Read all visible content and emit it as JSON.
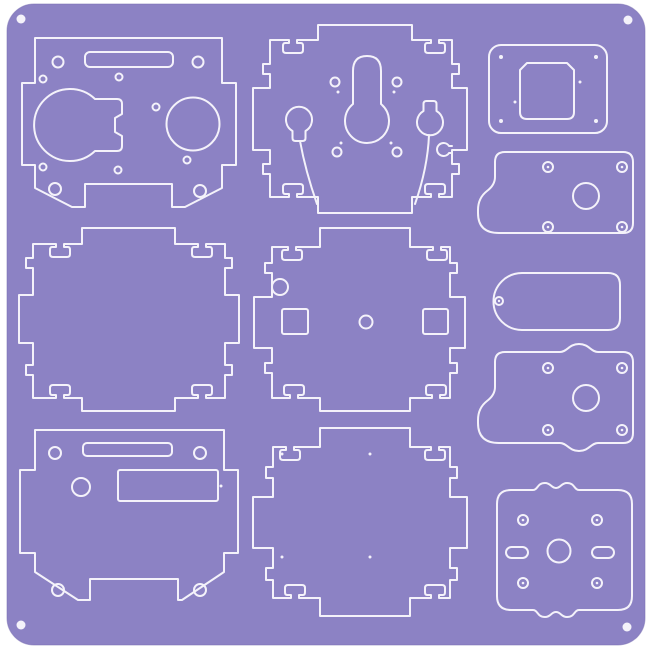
{
  "colors": {
    "page_background": "#ffffff",
    "sheet_fill": "#8c82c4",
    "sheet_edge": "#7a70b2",
    "cut_line": "#f4f2fa",
    "stroke_width": 2
  },
  "sheet": {
    "x": 7,
    "y": 4,
    "width": 638,
    "height": 641,
    "corner_radius": 27,
    "registration_dots": [
      {
        "cx": 21,
        "cy": 19,
        "r": 4.5
      },
      {
        "cx": 628,
        "cy": 20,
        "r": 4.5
      },
      {
        "cx": 21,
        "cy": 625,
        "r": 4.5
      },
      {
        "cx": 627,
        "cy": 627,
        "r": 4.5
      }
    ]
  },
  "parts": [
    {
      "name": "front-panel",
      "elements": [
        {
          "shape": "path",
          "name": "front-panel-outline",
          "d": "M 35,38 H 222 V 83 H 236 V 165 H 222 V 188 L 185,207 H 172 V 184 H 85 V 207 H 72 L 35,188 V 165 H 22 V 83 H 35 Z"
        },
        {
          "shape": "rect",
          "name": "front-panel-slot",
          "x": 85,
          "y": 52,
          "w": 88,
          "h": 15,
          "rx": 5
        },
        {
          "shape": "path",
          "name": "speaker-keyed-hole",
          "d": "M 95,99 A 36,36 0 1 0 95,151 H 117 Q 122,151 122,146 V 136 L 115,132 V 118 L 122,114 V 104 Q 122,99 117,99 Z"
        },
        {
          "shape": "circle",
          "name": "round-hole",
          "cx": 193,
          "cy": 124,
          "r": 26.5
        },
        {
          "shape": "circle",
          "name": "screw-hole",
          "cx": 58,
          "cy": 62,
          "r": 5.5
        },
        {
          "shape": "circle",
          "name": "screw-hole",
          "cx": 198,
          "cy": 62,
          "r": 5.5
        },
        {
          "shape": "circle",
          "name": "screw-hole",
          "cx": 55,
          "cy": 189,
          "r": 6
        },
        {
          "shape": "circle",
          "name": "screw-hole",
          "cx": 200,
          "cy": 191,
          "r": 6
        },
        {
          "shape": "circle",
          "name": "pin-hole",
          "cx": 43,
          "cy": 79,
          "r": 3.5
        },
        {
          "shape": "circle",
          "name": "pin-hole",
          "cx": 119,
          "cy": 77,
          "r": 3.5
        },
        {
          "shape": "circle",
          "name": "pin-hole",
          "cx": 156,
          "cy": 107,
          "r": 3.5
        },
        {
          "shape": "circle",
          "name": "pin-hole",
          "cx": 43,
          "cy": 167,
          "r": 3.5
        },
        {
          "shape": "circle",
          "name": "pin-hole",
          "cx": 118,
          "cy": 170,
          "r": 3.5
        },
        {
          "shape": "circle",
          "name": "pin-hole",
          "cx": 187,
          "cy": 160,
          "r": 3.5
        }
      ]
    },
    {
      "name": "side-panel-left",
      "elements": [
        {
          "shape": "path",
          "name": "side-panel-left-outline",
          "d": "M 33,244 H 56 V 247 H 52 Q 50,247 50,250 V 254 Q 50,257 53,257 H 67 Q 70,257 70,254 V 250 Q 70,247 68,247 H 64 V 244 H 82 V 228 H 175 V 244 H 198 V 247 H 194 Q 192,247 192,250 V 254 Q 192,257 195,257 H 209 Q 212,257 212,254 V 250 Q 212,247 210,247 H 206 V 244 H 225 V 258 H 232 V 268 H 225 V 295 H 239 V 343 H 225 V 365 H 232 V 375 H 225 V 398 H 206 V 395 H 210 Q 212,395 212,392 V 388 Q 212,385 209,385 H 195 Q 192,385 192,388 V 392 Q 192,395 194,395 H 198 V 398 H 175 V 411 H 82 V 398 H 64 V 395 H 68 Q 70,395 70,392 V 388 Q 70,385 67,385 H 53 Q 50,385 50,388 V 392 Q 50,395 52,395 H 56 V 398 H 33 V 375 H 26 V 365 H 33 V 343 H 19 V 295 H 33 V 268 H 26 V 258 H 33 Z"
        }
      ]
    },
    {
      "name": "bottom-panel",
      "elements": [
        {
          "shape": "path",
          "name": "bottom-panel-outline",
          "d": "M 35,430 H 224 V 470 H 238 V 553 H 224 V 572 L 182,600 H 178 V 579 H 90 V 600 H 78 L 35,572 V 553 H 20 V 470 H 35 Z"
        },
        {
          "shape": "rect",
          "name": "top-slot",
          "x": 83,
          "y": 443,
          "w": 89,
          "h": 13,
          "rx": 4
        },
        {
          "shape": "rect",
          "name": "display-window",
          "x": 118,
          "y": 470,
          "w": 100,
          "h": 31,
          "rx": 2
        },
        {
          "shape": "circle",
          "name": "round-hole",
          "cx": 81,
          "cy": 487,
          "r": 9
        },
        {
          "shape": "circle",
          "name": "screw-hole",
          "cx": 55,
          "cy": 453,
          "r": 6
        },
        {
          "shape": "circle",
          "name": "screw-hole",
          "cx": 200,
          "cy": 453,
          "r": 6
        },
        {
          "shape": "circle",
          "name": "screw-hole",
          "cx": 58,
          "cy": 590,
          "r": 6
        },
        {
          "shape": "circle",
          "name": "screw-hole",
          "cx": 200,
          "cy": 590,
          "r": 6
        },
        {
          "shape": "dot",
          "name": "pin-mark",
          "cx": 221,
          "cy": 486,
          "r": 1.5
        }
      ]
    },
    {
      "name": "back-panel",
      "elements": [
        {
          "shape": "path",
          "name": "back-panel-outline",
          "d": "M 270,40 H 289 V 43 H 285 Q 283,43 283,46 V 50 Q 283,53 286,53 H 300 Q 303,53 303,50 V 46 Q 303,43 301,43 H 297 V 40 H 318 V 25 H 412 V 40 H 431 V 43 H 427 Q 425,43 425,46 V 50 Q 425,53 428,53 H 442 Q 445,53 445,50 V 46 Q 445,43 443,43 H 439 V 40 H 452 V 64 H 459 V 74 H 452 V 88 H 467 V 150 H 452 V 164 H 459 V 174 H 452 V 197 H 439 V 194 H 443 Q 445,194 445,191 V 187 Q 445,184 442,184 H 428 Q 425,184 425,187 V 191 Q 425,194 427,194 H 431 V 197 H 412 V 213 H 318 V 197 H 297 V 194 H 301 Q 303,194 303,191 V 187 Q 303,184 300,184 H 286 Q 283,184 283,187 V 191 Q 283,194 285,194 H 289 V 197 H 270 V 174 H 263 V 164 H 270 V 150 H 253 V 88 H 270 V 74 H 263 V 64 H 270 Z"
        },
        {
          "shape": "path",
          "name": "keyhole-cutout",
          "d": "M 353,71 Q 353,56 367,56 Q 381,56 381,71 V 104 A 22,22 0 1 1 353,104 Z"
        },
        {
          "shape": "path",
          "name": "balloon-cutout-left",
          "d": "M 292.5,131 A 13,13 0 1 1 305.5,131 V 138 Q 305.5,141 302.5,141 H 295.5 Q 292.5,141 292.5,138 Z"
        },
        {
          "shape": "path",
          "name": "curved-cut-left",
          "d": "M 300,141 C 304,163 310,184 317,204"
        },
        {
          "shape": "path",
          "name": "balloon-cutout-right",
          "d": "M 423.5,111 V 104 Q 423.5,101 426.5,101 H 433.5 Q 436.5,101 436.5,104 V 111 A 13,13 0 1 1 423.5,111 Z"
        },
        {
          "shape": "path",
          "name": "curved-cut-right",
          "d": "M 429,135 C 428,160 422,184 415,204"
        },
        {
          "shape": "path",
          "name": "edge-keyhole-slot",
          "d": "M 452,146 H 449 A 6.5,6.5 0 1 0 449,153 H 452"
        },
        {
          "shape": "circle",
          "name": "screw-hole",
          "cx": 335,
          "cy": 82,
          "r": 4.5
        },
        {
          "shape": "circle",
          "name": "screw-hole",
          "cx": 397,
          "cy": 82,
          "r": 4.5
        },
        {
          "shape": "circle",
          "name": "screw-hole",
          "cx": 337,
          "cy": 152,
          "r": 4.5
        },
        {
          "shape": "circle",
          "name": "screw-hole",
          "cx": 397,
          "cy": 152,
          "r": 4.5
        },
        {
          "shape": "dot",
          "name": "pin-mark",
          "cx": 338,
          "cy": 92,
          "r": 1.5
        },
        {
          "shape": "dot",
          "name": "pin-mark",
          "cx": 394,
          "cy": 92,
          "r": 1.5
        },
        {
          "shape": "dot",
          "name": "pin-mark",
          "cx": 341,
          "cy": 143,
          "r": 1.5
        },
        {
          "shape": "dot",
          "name": "pin-mark",
          "cx": 391,
          "cy": 143,
          "r": 1.5
        }
      ]
    },
    {
      "name": "side-panel-right",
      "elements": [
        {
          "shape": "path",
          "name": "side-panel-right-outline",
          "d": "M 272,247 H 288 V 250 H 284 Q 282,250 282,253 V 257 Q 282,260 285,260 H 299 Q 302,260 302,257 V 253 Q 302,250 300,250 H 296 V 247 H 320 V 228 H 410 V 247 H 433 V 250 H 429 Q 427,250 427,253 V 257 Q 427,260 430,260 H 444 Q 447,260 447,257 V 253 Q 447,250 445,250 H 441 V 247 H 450 V 263 H 457 V 273 H 450 V 297 H 465 V 348 H 450 V 363 H 457 V 373 H 450 V 398 H 440 V 395 H 444 Q 446,395 446,392 V 388 Q 446,385 443,385 H 429 Q 426,385 426,388 V 392 Q 426,395 428,395 H 432 V 398 H 410 V 411 H 320 V 398 H 298 V 395 H 302 Q 304,395 304,392 V 388 Q 304,385 301,385 H 287 Q 284,385 284,388 V 392 Q 284,395 286,395 H 290 V 398 H 272 V 373 H 265 V 363 H 272 V 348 H 254 V 297 H 272 V 273 H 265 V 263 H 272 Z"
        },
        {
          "shape": "circle",
          "name": "edge-notch-hole",
          "cx": 280,
          "cy": 287,
          "r": 8
        },
        {
          "shape": "rect",
          "name": "square-hole",
          "x": 282,
          "y": 309,
          "w": 26,
          "h": 25,
          "rx": 2
        },
        {
          "shape": "rect",
          "name": "square-hole",
          "x": 423,
          "y": 309,
          "w": 25,
          "h": 25,
          "rx": 2
        },
        {
          "shape": "circle",
          "name": "center-hole",
          "cx": 366,
          "cy": 322,
          "r": 6.5
        }
      ]
    },
    {
      "name": "top-panel",
      "elements": [
        {
          "shape": "path",
          "name": "top-panel-outline",
          "d": "M 273,447 H 286 V 450 H 282 Q 280,450 280,453 V 457 Q 280,460 283,460 H 297 Q 300,460 300,457 V 453 Q 300,450 298,450 H 294 V 447 H 320 V 428 H 410 V 447 H 431 V 450 H 427 Q 425,450 425,453 V 457 Q 425,460 428,460 H 442 Q 445,460 445,457 V 453 Q 445,450 443,450 H 439 V 447 H 450 V 467 H 457 V 478 H 450 V 497 H 467 V 548 H 450 V 568 H 457 V 580 H 450 V 598 H 439 V 595 H 443 Q 445,595 445,592 V 588 Q 445,585 442,585 H 428 Q 425,585 425,588 V 592 Q 425,595 427,595 H 431 V 598 H 410 V 616 H 320 V 598 H 299 V 595 H 303 Q 305,595 305,592 V 588 Q 305,585 302,585 H 288 Q 285,585 285,588 V 592 Q 285,595 287,595 H 291 V 598 H 273 V 580 H 266 V 568 H 273 V 548 H 253 V 497 H 273 V 478 H 266 V 467 H 273 Z"
        },
        {
          "shape": "dot",
          "name": "pin-mark",
          "cx": 282,
          "cy": 454,
          "r": 1.5
        },
        {
          "shape": "dot",
          "name": "pin-mark",
          "cx": 370,
          "cy": 454,
          "r": 1.5
        },
        {
          "shape": "dot",
          "name": "pin-mark",
          "cx": 282,
          "cy": 557,
          "r": 1.5
        },
        {
          "shape": "dot",
          "name": "pin-mark",
          "cx": 370,
          "cy": 557,
          "r": 1.5
        }
      ]
    },
    {
      "name": "camera-plate",
      "elements": [
        {
          "shape": "rect",
          "name": "camera-plate-outline",
          "x": 489,
          "y": 45,
          "w": 118,
          "h": 88,
          "rx": 12
        },
        {
          "shape": "path",
          "name": "camera-window",
          "d": "M 527,63 H 567 L 574,70 V 112 Q 574,119 567,119 H 527 Q 520,119 520,112 V 70 Z"
        },
        {
          "shape": "dot",
          "name": "corner-mark",
          "cx": 501,
          "cy": 57,
          "r": 2
        },
        {
          "shape": "dot",
          "name": "corner-mark",
          "cx": 596,
          "cy": 57,
          "r": 2
        },
        {
          "shape": "dot",
          "name": "corner-mark",
          "cx": 501,
          "cy": 121,
          "r": 2
        },
        {
          "shape": "dot",
          "name": "corner-mark",
          "cx": 596,
          "cy": 121,
          "r": 2
        },
        {
          "shape": "dot",
          "name": "pin-mark",
          "cx": 515,
          "cy": 102,
          "r": 1.5
        },
        {
          "shape": "dot",
          "name": "pin-mark",
          "cx": 580,
          "cy": 82,
          "r": 1.5
        }
      ]
    },
    {
      "name": "bracket-plate-a",
      "elements": [
        {
          "shape": "path",
          "name": "bracket-plate-a-outline",
          "d": "M 505,152 H 623 Q 633,152 633,162 V 223 Q 633,233 623,233 H 499 Q 478,233 478,213 V 210 Q 478,198 487,191 Q 495,185 495,177 V 162 Q 495,152 505,152 Z"
        },
        {
          "shape": "circle",
          "name": "shaft-hole",
          "cx": 586,
          "cy": 196,
          "r": 13
        },
        {
          "shape": "circle",
          "name": "screw-hole",
          "cx": 548,
          "cy": 167,
          "r": 5
        },
        {
          "shape": "circle",
          "name": "screw-hole",
          "cx": 622,
          "cy": 167,
          "r": 5
        },
        {
          "shape": "circle",
          "name": "screw-hole",
          "cx": 548,
          "cy": 227,
          "r": 5
        },
        {
          "shape": "circle",
          "name": "screw-hole",
          "cx": 622,
          "cy": 227,
          "r": 5
        },
        {
          "shape": "dot",
          "name": "drill-mark",
          "cx": 548,
          "cy": 167,
          "r": 1.3
        },
        {
          "shape": "dot",
          "name": "drill-mark",
          "cx": 622,
          "cy": 167,
          "r": 1.3
        },
        {
          "shape": "dot",
          "name": "drill-mark",
          "cx": 548,
          "cy": 227,
          "r": 1.3
        },
        {
          "shape": "dot",
          "name": "drill-mark",
          "cx": 622,
          "cy": 227,
          "r": 1.3
        }
      ]
    },
    {
      "name": "pill-plate",
      "elements": [
        {
          "shape": "path",
          "name": "pill-plate-outline",
          "d": "M 522,273 H 608 Q 620,273 620,285 V 318 Q 620,330 608,330 H 522 A 28.5,28.5 0 0 1 522,273 Z"
        },
        {
          "shape": "circle",
          "name": "screw-hole",
          "cx": 499,
          "cy": 301,
          "r": 4
        },
        {
          "shape": "dot",
          "name": "drill-mark",
          "cx": 499,
          "cy": 301,
          "r": 1.2
        }
      ]
    },
    {
      "name": "bracket-plate-b",
      "elements": [
        {
          "shape": "path",
          "name": "bracket-plate-b-outline",
          "d": "M 505,352 H 560 C 567,352 569,344 579,344 C 589,344 591,352 598,352 H 623 Q 633,352 633,362 V 433 Q 633,443 623,443 H 598 C 591,443 589,451 579,451 C 569,451 567,443 560,443 H 499 Q 478,443 478,423 V 420 Q 478,408 487,401 Q 495,395 495,387 V 362 Q 495,352 505,352 Z"
        },
        {
          "shape": "circle",
          "name": "shaft-hole",
          "cx": 586,
          "cy": 398,
          "r": 13
        },
        {
          "shape": "circle",
          "name": "screw-hole",
          "cx": 548,
          "cy": 368,
          "r": 5
        },
        {
          "shape": "circle",
          "name": "screw-hole",
          "cx": 622,
          "cy": 368,
          "r": 5
        },
        {
          "shape": "circle",
          "name": "screw-hole",
          "cx": 548,
          "cy": 430,
          "r": 5
        },
        {
          "shape": "circle",
          "name": "screw-hole",
          "cx": 622,
          "cy": 430,
          "r": 5
        },
        {
          "shape": "dot",
          "name": "drill-mark",
          "cx": 548,
          "cy": 368,
          "r": 1.3
        },
        {
          "shape": "dot",
          "name": "drill-mark",
          "cx": 622,
          "cy": 368,
          "r": 1.3
        },
        {
          "shape": "dot",
          "name": "drill-mark",
          "cx": 548,
          "cy": 430,
          "r": 1.3
        },
        {
          "shape": "dot",
          "name": "drill-mark",
          "cx": 622,
          "cy": 430,
          "r": 1.3
        }
      ]
    },
    {
      "name": "motor-plate",
      "elements": [
        {
          "shape": "path",
          "name": "motor-plate-outline",
          "d": "M 511,490 H 533 C 538,490 537,483 545,483 C 551,483 551,488 556,488 C 561,488 561,483 567,483 C 575,483 574,490 579,490 H 618 Q 632,490 632,504 V 596 Q 632,610 618,610 H 579 C 574,610 575,617 567,617 C 561,617 561,612 556,612 C 551,612 551,617 545,617 C 537,617 538,610 533,610 H 511 Q 497,610 497,596 V 504 Q 497,490 511,490 Z"
        },
        {
          "shape": "circle",
          "name": "shaft-hole",
          "cx": 559,
          "cy": 551,
          "r": 11.5
        },
        {
          "shape": "rect",
          "name": "slot-hole",
          "x": 506,
          "y": 547,
          "w": 22,
          "h": 11,
          "rx": 5.5
        },
        {
          "shape": "rect",
          "name": "slot-hole",
          "x": 592,
          "y": 547,
          "w": 22,
          "h": 11,
          "rx": 5.5
        },
        {
          "shape": "circle",
          "name": "screw-hole",
          "cx": 523,
          "cy": 520,
          "r": 5
        },
        {
          "shape": "circle",
          "name": "screw-hole",
          "cx": 597,
          "cy": 520,
          "r": 5
        },
        {
          "shape": "circle",
          "name": "screw-hole",
          "cx": 523,
          "cy": 583,
          "r": 5
        },
        {
          "shape": "circle",
          "name": "screw-hole",
          "cx": 597,
          "cy": 583,
          "r": 5
        },
        {
          "shape": "dot",
          "name": "drill-mark",
          "cx": 523,
          "cy": 520,
          "r": 1.3
        },
        {
          "shape": "dot",
          "name": "drill-mark",
          "cx": 597,
          "cy": 520,
          "r": 1.3
        },
        {
          "shape": "dot",
          "name": "drill-mark",
          "cx": 523,
          "cy": 583,
          "r": 1.3
        },
        {
          "shape": "dot",
          "name": "drill-mark",
          "cx": 597,
          "cy": 583,
          "r": 1.3
        }
      ]
    }
  ]
}
